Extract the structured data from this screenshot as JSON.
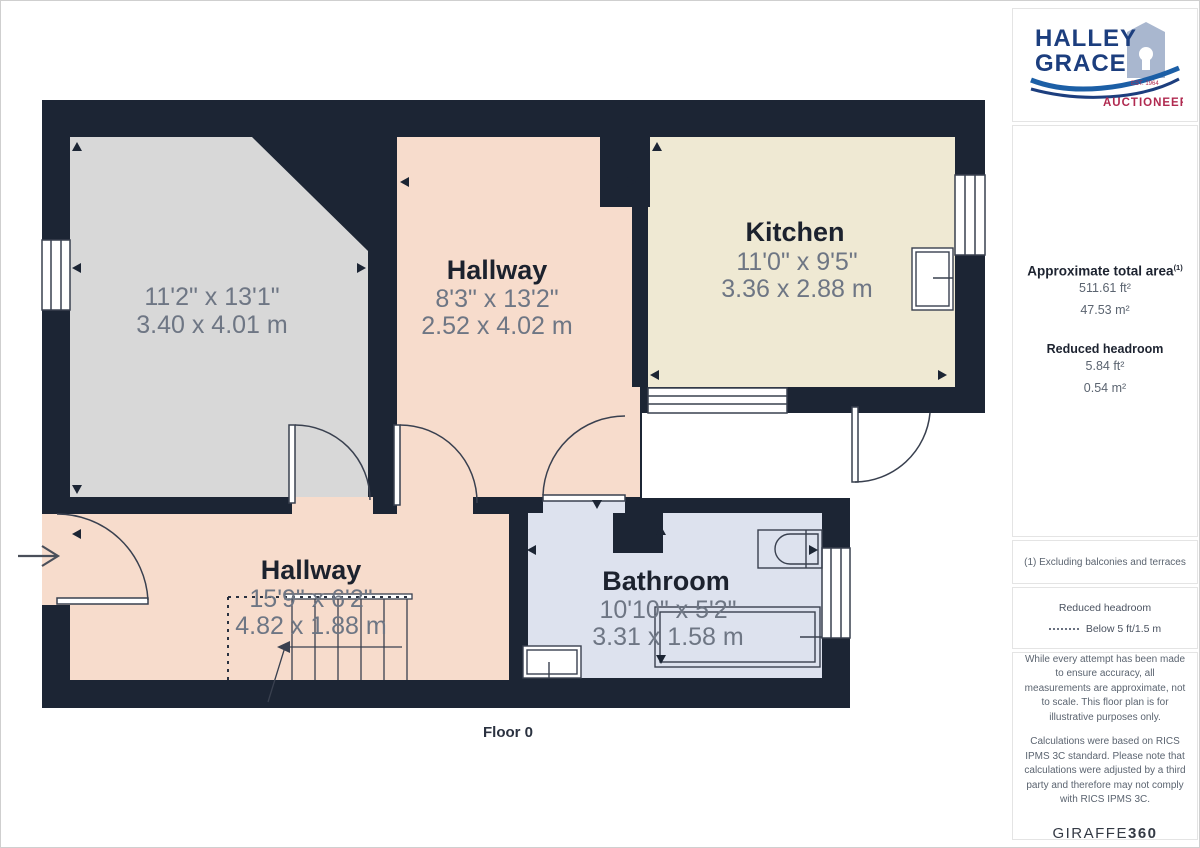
{
  "branding": {
    "line1": "HALLEY",
    "line2": "GRACE",
    "est": "EST. 1964",
    "sub": "AUCTIONEERS"
  },
  "sidebar": {
    "total_area_label": "Approximate total area",
    "total_area_footnote_marker": "(1)",
    "total_area_ft": "511.61 ft²",
    "total_area_m": "47.53 m²",
    "reduced_label": "Reduced headroom",
    "reduced_ft": "5.84 ft²",
    "reduced_m": "0.54 m²",
    "footnote": "(1) Excluding balconies and terraces",
    "legend_title": "Reduced headroom",
    "legend_value": "Below 5 ft/1.5 m",
    "disclaimer1": "While every attempt has been made to ensure accuracy, all measurements are approximate, not to scale. This floor plan is for illustrative purposes only.",
    "disclaimer2": "Calculations were based on RICS IPMS 3C standard. Please note that calculations were adjusted by a third party and therefore may not comply with RICS IPMS 3C.",
    "brand_name": "GIRAFFE",
    "brand_number": "360"
  },
  "floorplan": {
    "floor_label": "Floor 0",
    "rooms": [
      {
        "name": "",
        "dim_imperial": "11'2\" x 13'1\"",
        "dim_metric": "3.40 x 4.01 m"
      },
      {
        "name": "Hallway",
        "dim_imperial": "8'3\" x 13'2\"",
        "dim_metric": "2.52 x 4.02 m"
      },
      {
        "name": "Kitchen",
        "dim_imperial": "11'0\" x 9'5\"",
        "dim_metric": "3.36 x 2.88 m"
      },
      {
        "name": "Hallway",
        "dim_imperial": "15'9\" x 6'2\"",
        "dim_metric": "4.82 x 1.88 m"
      },
      {
        "name": "Bathroom",
        "dim_imperial": "10'10\" x 5'2\"",
        "dim_metric": "3.31 x 1.58 m"
      }
    ],
    "colors": {
      "wall": "#1c2534",
      "room_gray": "#d8d8d8",
      "room_salmon": "#f7dccc",
      "room_cream": "#efe9d3",
      "room_blue": "#dde2ee"
    }
  }
}
